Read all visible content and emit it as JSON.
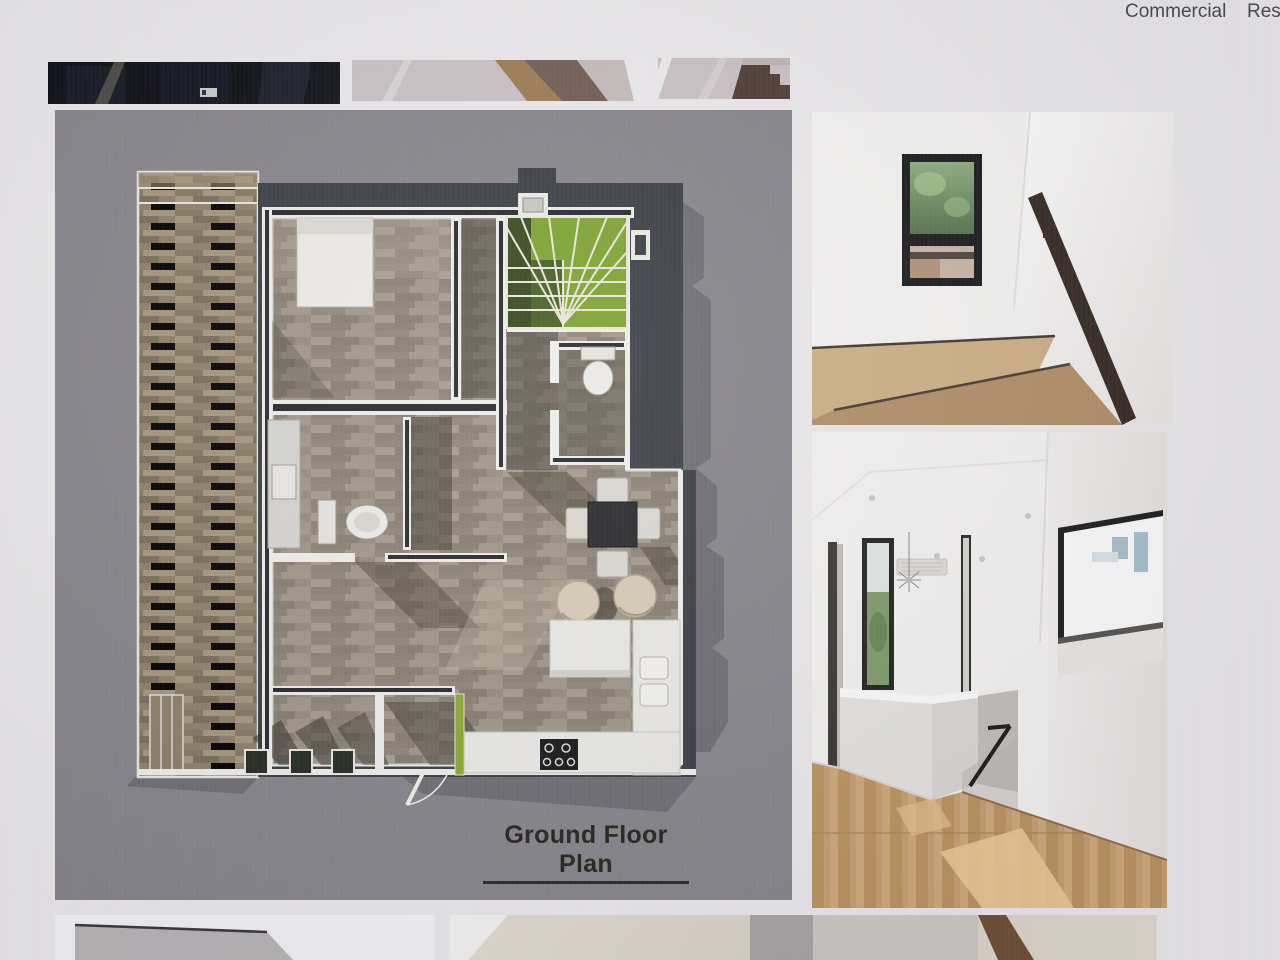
{
  "nav": {
    "items": [
      {
        "label": "Commercial"
      },
      {
        "label": "Res"
      }
    ]
  },
  "gallery": {
    "floor_plan": {
      "title": "Ground Floor Plan"
    },
    "thumbnails": [
      {
        "name": "dark-interior-thumbnail"
      },
      {
        "name": "hallway-wood-stair-thumbnail"
      },
      {
        "name": "stair-steps-thumbnail"
      }
    ],
    "photos": [
      {
        "name": "stair-landing-window-photo"
      },
      {
        "name": "upstairs-hallway-photo"
      },
      {
        "name": "gray-wall-detail-photo"
      },
      {
        "name": "beige-interior-detail-photo"
      }
    ]
  },
  "colors": {
    "page_background": "#eae8ea",
    "plan_panel_gray": "#86848a",
    "wall_charcoal": "#3a3d43",
    "stair_green": "#7ca22d",
    "accent_green": "#8aa92f",
    "deck_wood": "#94866f",
    "floor_wood": "#a1968a",
    "photo_wood": "#c49e6f",
    "nav_text": "#4a4a4c",
    "title_text": "#26251f"
  }
}
